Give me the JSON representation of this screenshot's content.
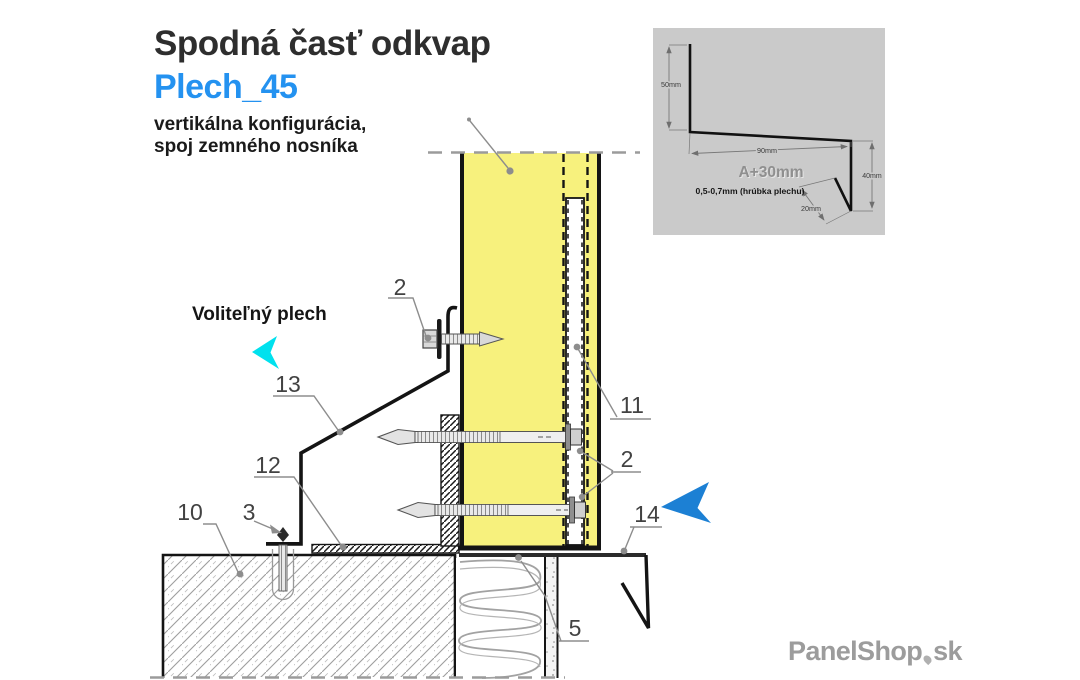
{
  "header": {
    "title": "Spodná časť odkvap",
    "model": "Plech_45",
    "desc_line1": "vertikálna konfigurácia,",
    "desc_line2": "spoj zemného nosníka"
  },
  "annotation": {
    "optional_sheet_label": "Voliteľný plech"
  },
  "callouts": {
    "c2_top": "2",
    "c13": "13",
    "c12": "12",
    "c10": "10",
    "c3": "3",
    "c11": "11",
    "c2_right": "2",
    "c14": "14",
    "c5": "5"
  },
  "inset": {
    "dim_height_top": "50mm",
    "dim_width": "90mm",
    "dim_label": "A+30mm",
    "thickness_note": "0,5-0,7mm (hrúbka plechu)",
    "dim_height_right": "40mm",
    "dim_kick": "20mm"
  },
  "brand": {
    "name": "PanelShop",
    "tld": "sk"
  },
  "colors": {
    "accent_blue": "#2492f0",
    "panel_yellow": "#f7f17d",
    "arrow_cyan": "#00e1ee",
    "arrow_blue": "#1c80d4",
    "inset_bg": "#cacaca",
    "logo_gray": "#9c9c9c"
  }
}
